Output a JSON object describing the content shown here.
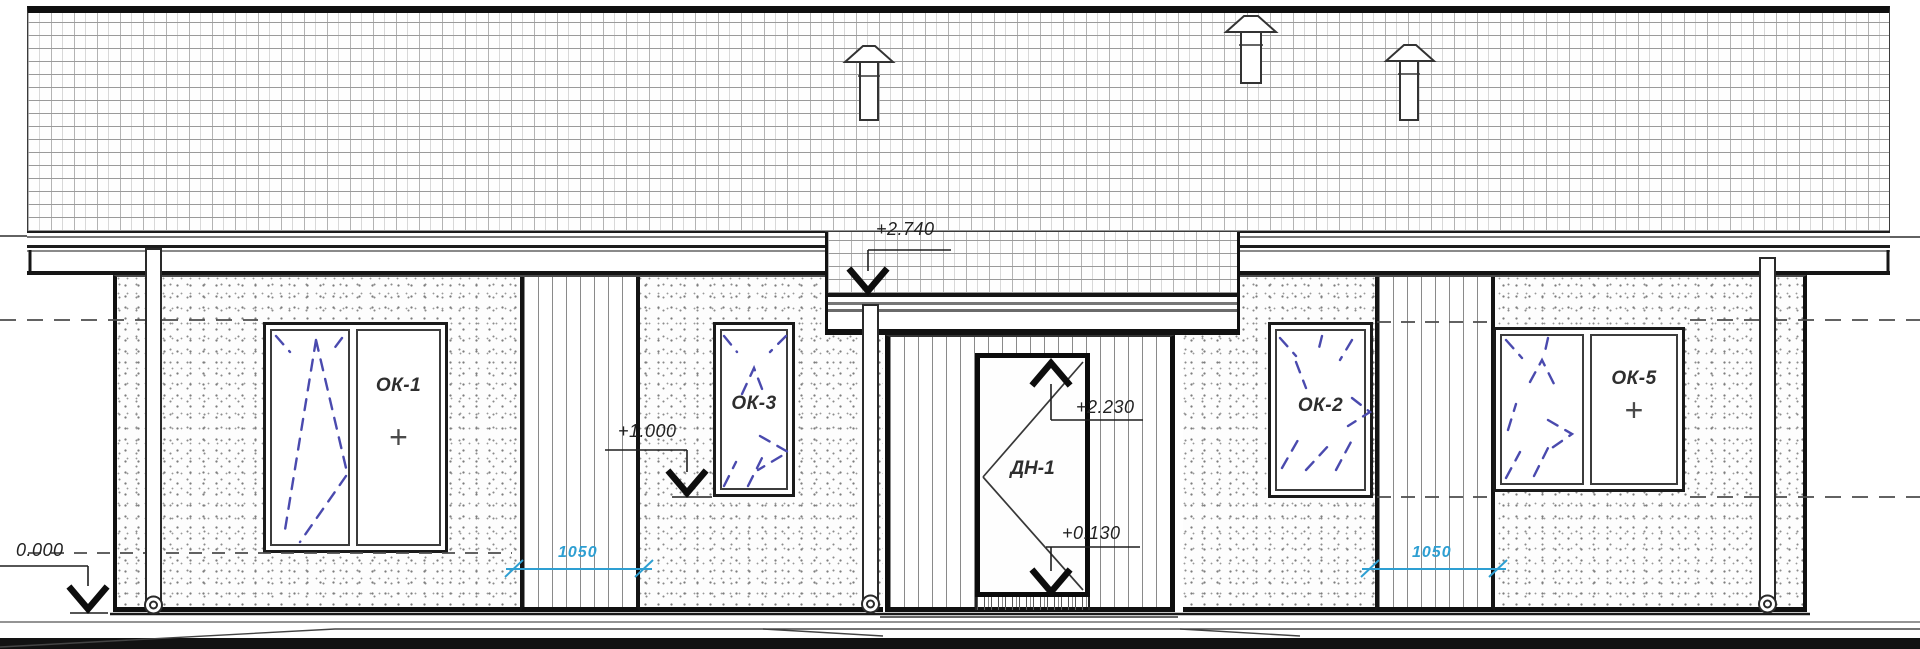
{
  "drawing": {
    "name": "building facade elevation",
    "windows": [
      {
        "id": "OK-1",
        "label": "ОК-1",
        "handle": "+"
      },
      {
        "id": "OK-3",
        "label": "ОК-3"
      },
      {
        "id": "OK-2",
        "label": "ОК-2"
      },
      {
        "id": "OK-5",
        "label": "ОК-5",
        "handle": "+"
      }
    ],
    "door": {
      "id": "DN-1",
      "label": "ДН-1"
    },
    "elevation_marks": {
      "canopy_top": "+2.740",
      "window_sill": "+1.000",
      "door_head": "+2.230",
      "porch_threshold": "+0.130",
      "ground": "0.000"
    },
    "dimensions": {
      "left_siding_width": "1050",
      "right_siding_width": "1050"
    },
    "colors": {
      "dimension_blue": "#2e9fd2",
      "glass_mark_blue": "#4a4aae",
      "ink": "#1c1c1c"
    }
  }
}
